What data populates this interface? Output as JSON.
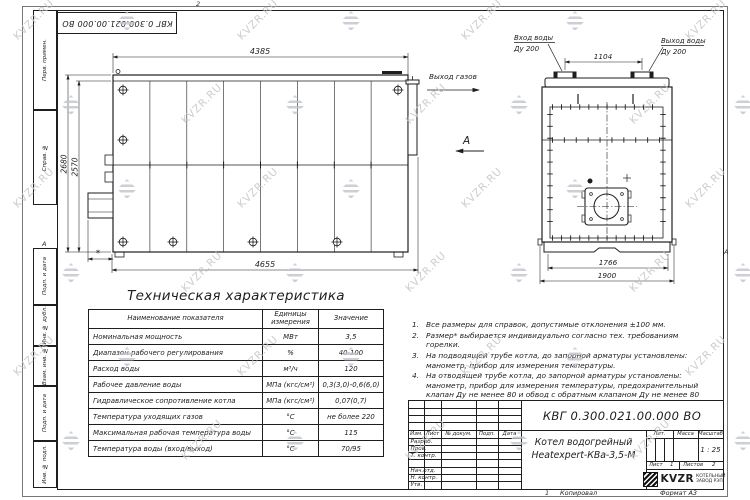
{
  "watermark": {
    "text": "KVZR.RU"
  },
  "frame": {
    "top_stamp": "КВГ 0.300.021.00.000 ВО",
    "left_labels": [
      "Перв. примен.",
      "Справ. №",
      "Подп. и дата",
      "Инв. № дубл.",
      "Взам. инв. №",
      "Подп. и дата",
      "Инв. № подл."
    ],
    "zone_top": "2",
    "zone_bottom": "1",
    "zone_left": "А",
    "zone_right": "А",
    "footer_copy": "Копировал",
    "footer_format": "Формат А3"
  },
  "side_view": {
    "dim_top": "4385",
    "dim_bottom": "4655",
    "dim_height_outer": "2680",
    "dim_height_inner": "2570",
    "dim_burner": "*",
    "label_gas": "Выход газов",
    "view_label": "А"
  },
  "end_view": {
    "dim_nozzles": "1104",
    "dim_inner": "1766",
    "dim_outer": "1900",
    "inlet_line1": "Вход воды",
    "inlet_line2": "Ду 200",
    "outlet_line1": "Выход воды",
    "outlet_line2": "Ду 200"
  },
  "spec_table": {
    "title": "Техническая характеристика",
    "headers": [
      "Наименование показателя",
      "Единицы измерения",
      "Значение"
    ],
    "rows": [
      [
        "Номинальная мощность",
        "МВт",
        "3,5"
      ],
      [
        "Диапазон рабочего регулирования",
        "%",
        "40-100"
      ],
      [
        "Расход воды",
        "м³/ч",
        "120"
      ],
      [
        "Рабочее давление воды",
        "МПа (кгс/см²)",
        "0,3(3,0)-0,6(6,0)"
      ],
      [
        "Гидравлическое сопротивление котла",
        "МПа (кгс/см²)",
        "0,07(0,7)"
      ],
      [
        "Температура уходящих газов",
        "°С",
        "не более 220"
      ],
      [
        "Максимальная рабочая температура воды",
        "°С",
        "115"
      ],
      [
        "Температура воды (вход/выход)",
        "°С",
        "70/95"
      ]
    ]
  },
  "notes": [
    {
      "n": "1.",
      "t": "Все размеры для справок, допустимые отклонения ±100 мм."
    },
    {
      "n": "2.",
      "t": "Размер* выбирается индивидуально согласно тех. требованиям горелки."
    },
    {
      "n": "3.",
      "t": "На подводящей трубе котла, до запорной арматуры установлены: манометр, прибор для измерения температуры."
    },
    {
      "n": "4.",
      "t": "На отводящей трубе котла, до запорной арматуры установлены: манометр, прибор для измерения температуры, предохранительный клапан Ду не менее 80 и обвод с обратным клапаном Ду не менее 80 мм."
    }
  ],
  "title_block": {
    "doc_number": "КВГ 0.300.021.00.000 ВО",
    "name_line1": "Котел водогрейный",
    "name_line2": "Heatexpert-КВа-3,5-М",
    "header_cols": [
      "Изм.",
      "Лист",
      "№ докум.",
      "Подп.",
      "Дата"
    ],
    "role_rows": [
      "Разраб.",
      "Пров.",
      "Т. контр.",
      "Нач.отд.",
      "Н. контр.",
      "Утв."
    ],
    "lit_label": "Лит.",
    "mass_label": "Масса",
    "scale_label": "Масштаб",
    "scale_value": "1 : 25",
    "sheet_label": "Лист",
    "sheet_value": "1",
    "sheets_label": "Листов",
    "sheets_value": "2",
    "company": {
      "logo_text": "KVZR",
      "line1": "КОТЕЛЬНЫЙ",
      "line2": "ЗАВОД РЭП"
    }
  }
}
